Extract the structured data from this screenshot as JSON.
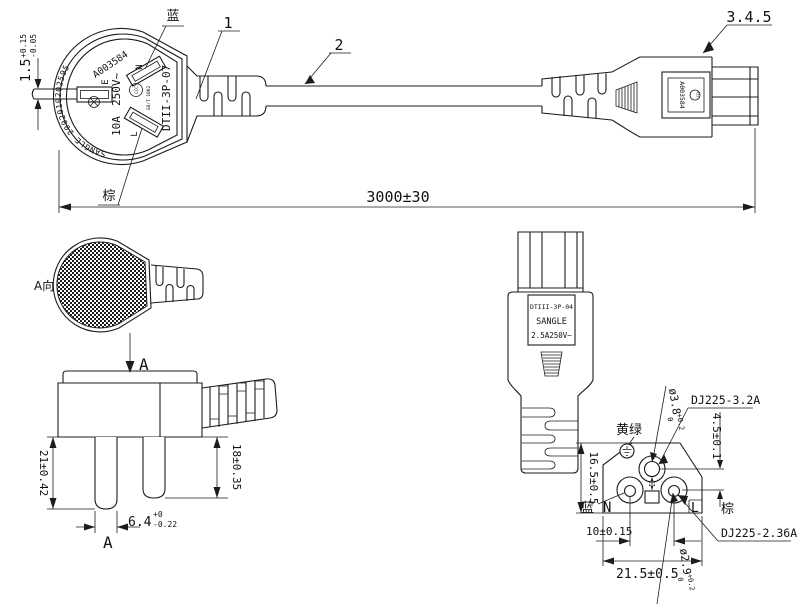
{
  "top_view": {
    "callout_strain_relief": "1",
    "callout_cable": "2",
    "callout_connector": "3.4.5",
    "dim_total_length": "3000±30",
    "dim_earth_pin": {
      "value": "1.5",
      "tol_plus": "+0.15",
      "tol_minus": "-0.05"
    },
    "label_blue": "蓝",
    "label_brown": "棕",
    "plug_marking": {
      "serial": "A003584",
      "rim_text": "SANGLE 2002010202595",
      "voltage": "250V~",
      "current": "10A",
      "earth": "E",
      "neutral": "N",
      "live": "L",
      "model": "DTII-3P-07",
      "ccc": "CCC",
      "standard": "GB/T 1002"
    },
    "connector_marking": {
      "serial": "A003584",
      "ccc": "CCC"
    }
  },
  "plug_detail": {
    "view_direction_label": "A向",
    "arrow_label": "A",
    "section_label": "A",
    "dim_earth_pin_length": "21±0.42",
    "dim_pin_length": "18±0.35",
    "dim_pin_width": {
      "value": "6.4",
      "tol_plus": "+0",
      "tol_minus": "-0.22"
    }
  },
  "connector_detail": {
    "marking": {
      "model": "DTIII-3P-04",
      "brand": "SANGLE",
      "rating": "2.5A250V~"
    }
  },
  "connector_face": {
    "label_yellow_green": "黄绿",
    "label_blue": "蓝",
    "label_brown": "棕",
    "neutral": "N",
    "live": "L",
    "dim_earth_hole": {
      "value": "ø3.8",
      "tol_plus": "+0.2",
      "tol_minus": "0"
    },
    "dim_pin_hole": {
      "value": "ø2.9",
      "tol_plus": "+0.2",
      "tol_minus": "0"
    },
    "earth_terminal": "DJ225-3.2A",
    "pin_terminal": "DJ225-2.36A",
    "dim_earth_offset": "4.5±0.1",
    "dim_height": "16.5±0.5",
    "dim_pin_pitch": "10±0.15",
    "dim_width": "21.5±0.5"
  }
}
